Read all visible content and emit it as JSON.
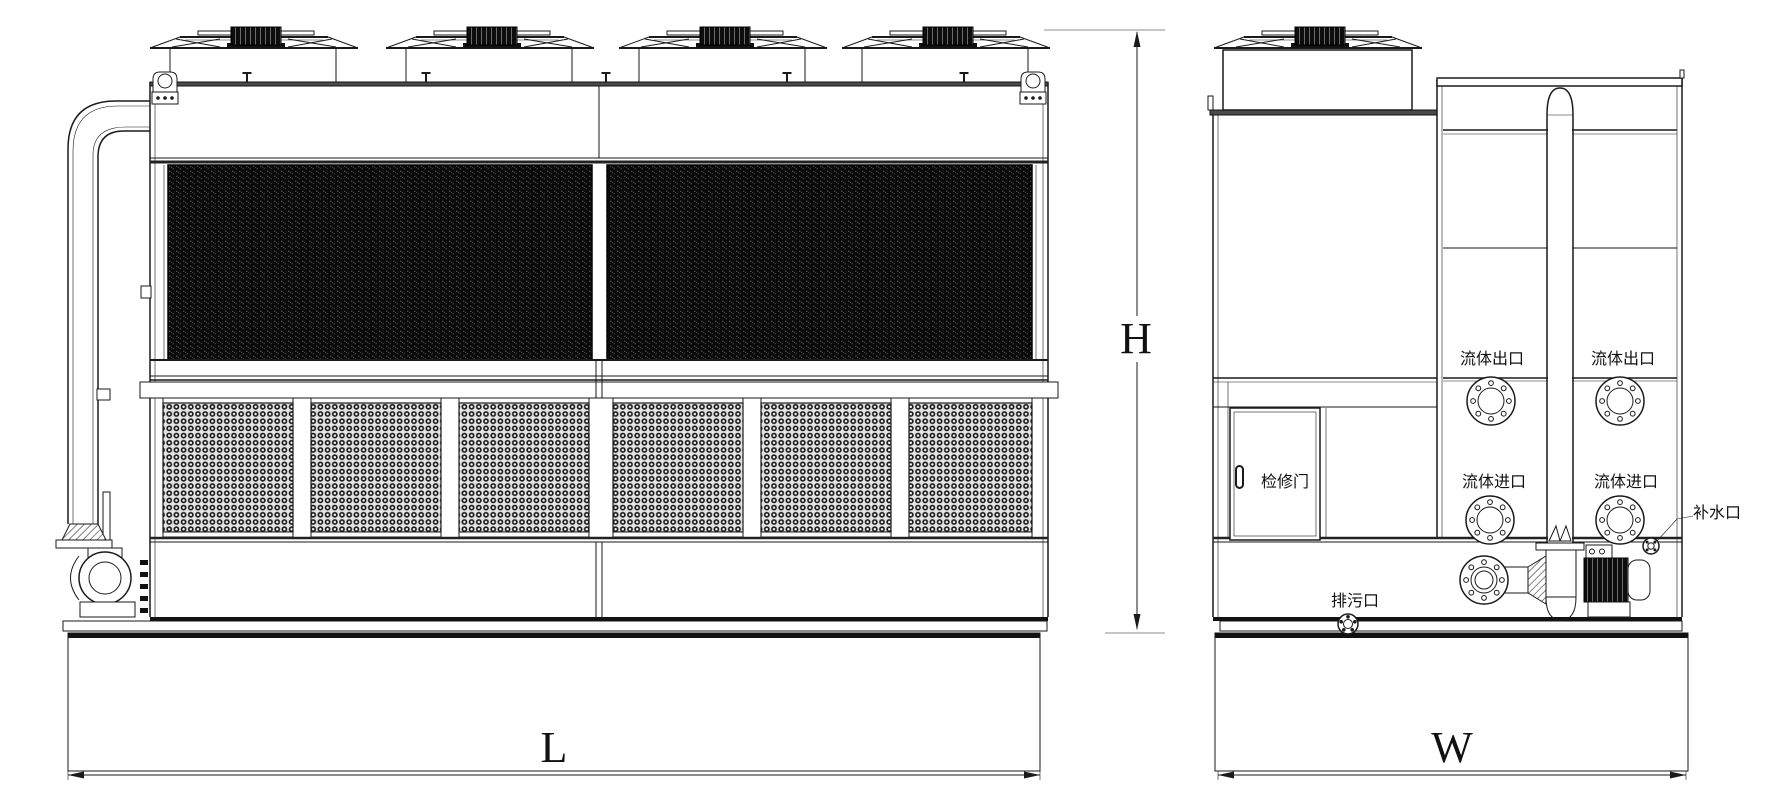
{
  "drawing": {
    "kind": "closed-circuit cooling tower two-view engineering drawing",
    "colors": {
      "line": "#1a1a1a",
      "background": "#ffffff",
      "coil_panel": "#0a0a0a"
    },
    "dimensions": {
      "height": "H",
      "length": "L",
      "width": "W"
    },
    "side_view": {
      "labels": {
        "fluid_outlet_left": "流体出口",
        "fluid_outlet_right": "流体出口",
        "fluid_inlet_left": "流体进口",
        "fluid_inlet_right": "流体进口",
        "access_door": "检修门",
        "makeup_water": "补水口",
        "drain": "排污口"
      }
    }
  }
}
